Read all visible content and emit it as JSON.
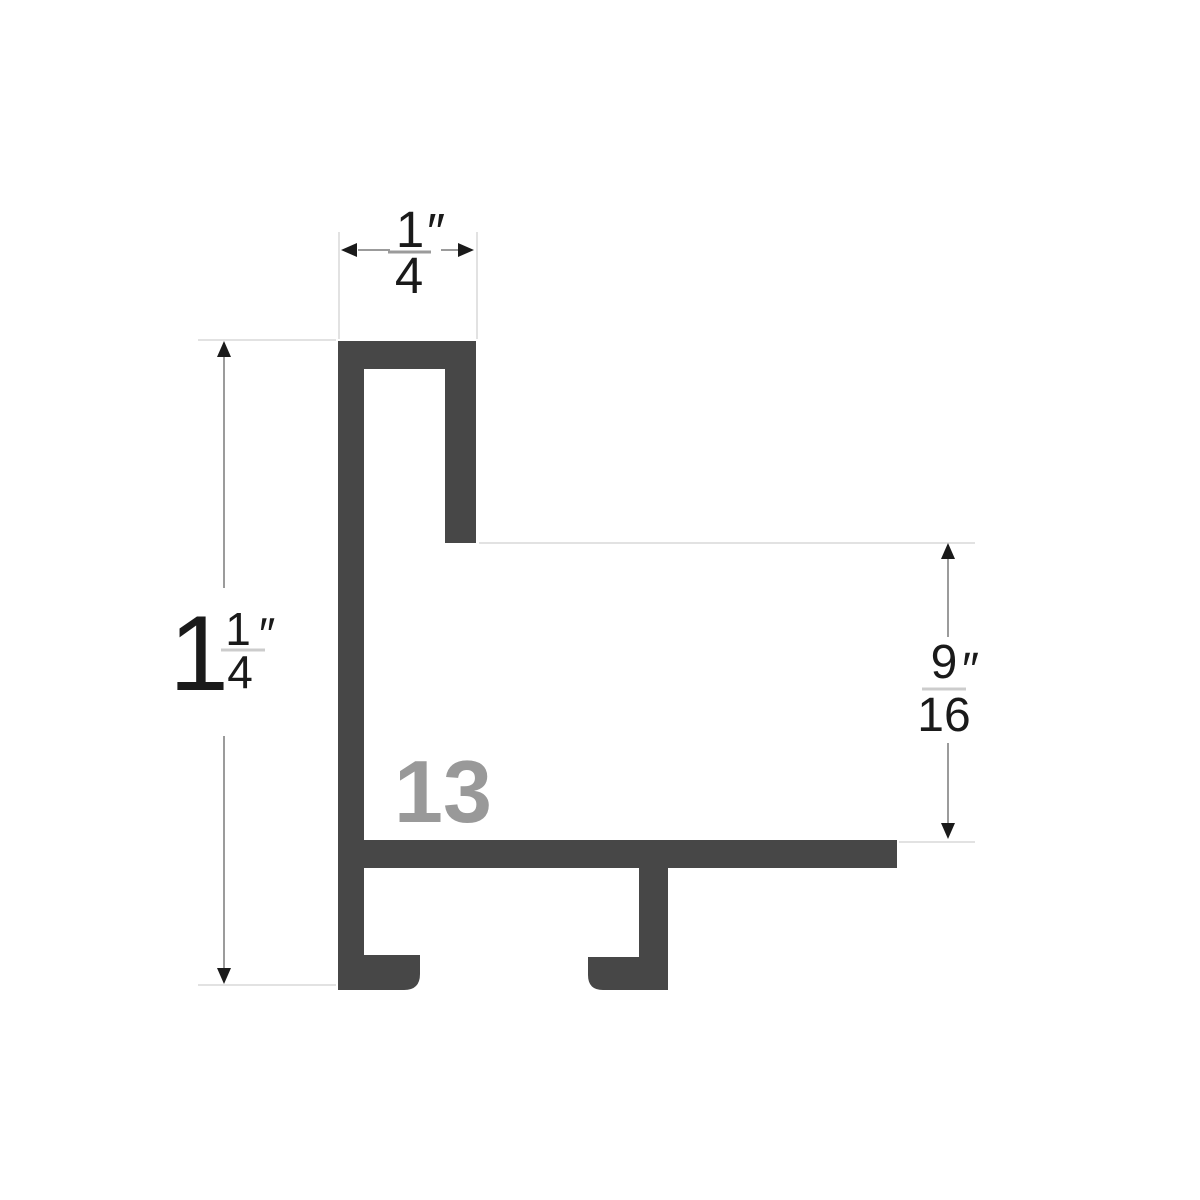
{
  "diagram": {
    "profile_label": "13",
    "dimensions": {
      "top_width": {
        "numerator": "1",
        "denominator": "4",
        "unit_mark": "″",
        "display": "1/4″"
      },
      "left_height": {
        "whole": "1",
        "numerator": "1",
        "denominator": "4",
        "unit_mark": "″",
        "display": "1 1/4″"
      },
      "right_height": {
        "numerator": "9",
        "denominator": "16",
        "unit_mark": "″",
        "display": "9/16″"
      }
    },
    "colors": {
      "profile_fill": "#474747",
      "profile_label_color": "#999999",
      "dimension_line": "#9b9b9b",
      "extension_line": "#e2e2e2",
      "fraction_bar_light": "#cccccc",
      "arrow_color": "#1a1a1a",
      "text_color": "#1a1a1a",
      "background": "#ffffff"
    }
  }
}
